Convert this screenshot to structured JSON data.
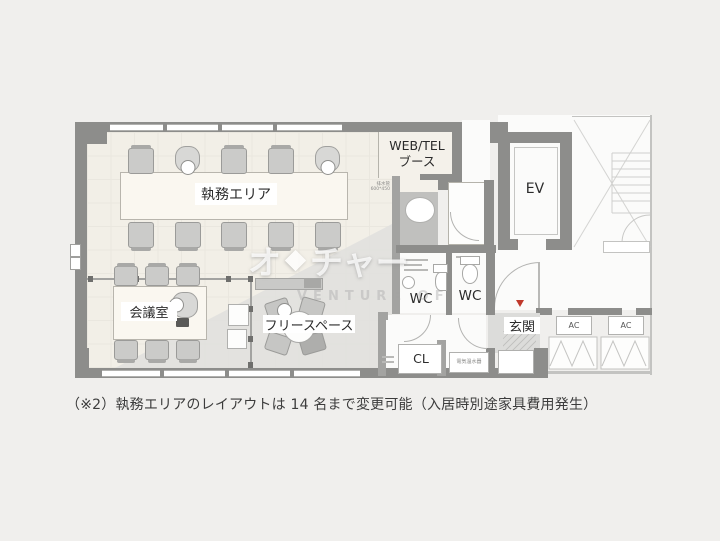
{
  "plan": {
    "rooms": {
      "work_area": "執務エリア",
      "meeting_room": "会議室",
      "free_space": "フリースペース",
      "booth_line1": "WEB/TEL",
      "booth_line2": "ブース",
      "elevator": "EV",
      "wc_left": "WC",
      "wc_right": "WC",
      "entrance": "玄関",
      "closet": "CL",
      "ac_unit_left": "AC",
      "ac_unit_right": "AC"
    },
    "small_labels": {
      "drain_line1": "排水管",
      "drain_line2": "600*450",
      "water_heater": "電気温水器"
    }
  },
  "watermark": {
    "kana_left": "オ",
    "kana_right": "チャー",
    "latin": "VENTURE OF"
  },
  "caption": "（※2）執務エリアのレイアウトは 14 名まで変更可能（入居時別途家具費用発生）",
  "colors": {
    "wall": "#8d8d8b",
    "floor_beige": "#f2efe7",
    "floor_gray": "#e0e0de",
    "entrance_marker": "#c0392b"
  }
}
